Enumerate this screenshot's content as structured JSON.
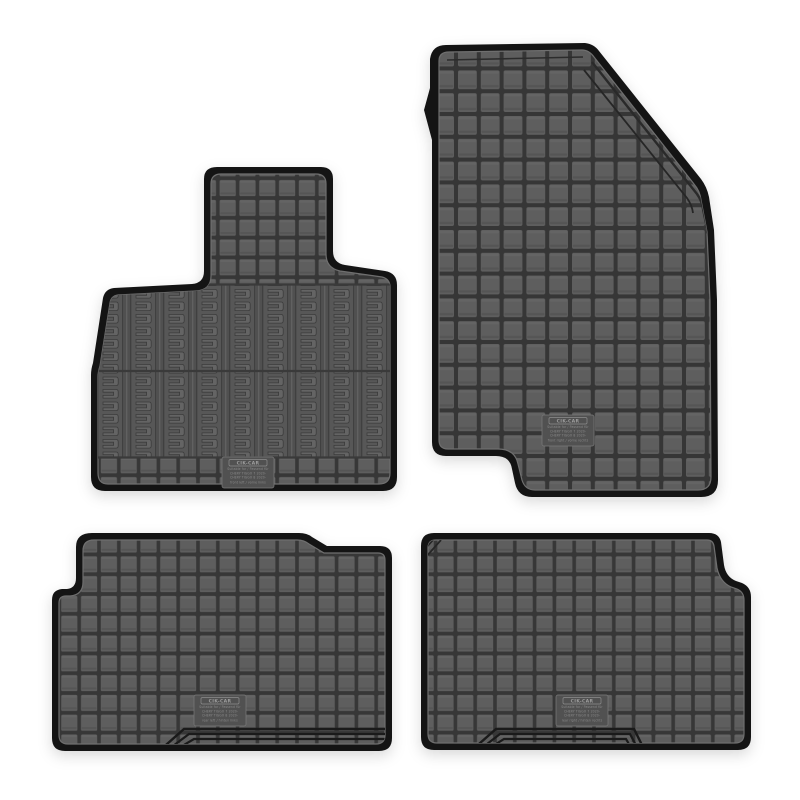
{
  "scene": {
    "description": "Product photo on white background: set of four black rubber car floor mats with square checker tread pattern (two front mats, two rear mats)",
    "background_color": "#ffffff",
    "mat_surface_color": "#5e5e5e",
    "tread_gap_color": "#373737",
    "edge_border_color": "#141414",
    "ridge_highlight_color": "#6f6f6f"
  },
  "label": {
    "brand": "CIK-CAR",
    "suitable_line": "Suitable for / Passend für",
    "model_line_1": "CHERY TIGGO 7  2020-",
    "model_line_2": "CHERY TIGGO 8 2020-"
  },
  "mats": [
    {
      "name": "front left mat",
      "position_line": "front left / vorne links"
    },
    {
      "name": "front right mat",
      "position_line": "front right / vorne rechts"
    },
    {
      "name": "rear left mat",
      "position_line": "rear left / hinten links"
    },
    {
      "name": "rear right mat",
      "position_line": "rear right / hinten rechts"
    }
  ]
}
